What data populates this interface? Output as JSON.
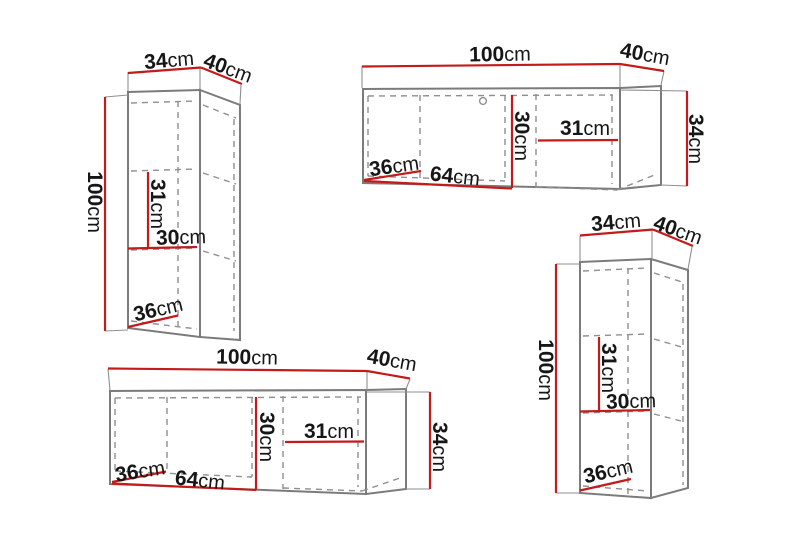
{
  "page": {
    "background": "#ffffff",
    "description_labels_only": true
  },
  "colors": {
    "measure_line": "#c41a1a",
    "cabinet_outline": "#7b7b7b",
    "interior_dashed": "#8f8f8f",
    "label_text": "#161616"
  },
  "cabinets": [
    {
      "name": "tall-wall-cabinet-top-left",
      "orientation": "vertical",
      "dimensions": {
        "width": {
          "value": "34",
          "unit": "cm"
        },
        "depth": {
          "value": "40",
          "unit": "cm"
        },
        "height": {
          "value": "100",
          "unit": "cm"
        },
        "compartment_height": {
          "value": "31",
          "unit": "cm"
        },
        "compartment_width": {
          "value": "30",
          "unit": "cm"
        },
        "base_depth": {
          "value": "36",
          "unit": "cm"
        }
      }
    },
    {
      "name": "wide-wall-cabinet-top-right",
      "orientation": "horizontal",
      "has_knob": true,
      "dimensions": {
        "width": {
          "value": "100",
          "unit": "cm"
        },
        "depth": {
          "value": "40",
          "unit": "cm"
        },
        "height": {
          "value": "34",
          "unit": "cm"
        },
        "compartment_height": {
          "value": "30",
          "unit": "cm"
        },
        "compartment_width": {
          "value": "31",
          "unit": "cm"
        },
        "base_depth": {
          "value": "36",
          "unit": "cm"
        },
        "door_width": {
          "value": "64",
          "unit": "cm"
        }
      }
    },
    {
      "name": "wide-wall-cabinet-bottom-left",
      "orientation": "horizontal",
      "has_knob": false,
      "dimensions": {
        "width": {
          "value": "100",
          "unit": "cm"
        },
        "depth": {
          "value": "40",
          "unit": "cm"
        },
        "height": {
          "value": "34",
          "unit": "cm"
        },
        "compartment_height": {
          "value": "30",
          "unit": "cm"
        },
        "compartment_width": {
          "value": "31",
          "unit": "cm"
        },
        "base_depth": {
          "value": "36",
          "unit": "cm"
        },
        "door_width": {
          "value": "64",
          "unit": "cm"
        }
      }
    },
    {
      "name": "tall-wall-cabinet-bottom-right",
      "orientation": "vertical",
      "dimensions": {
        "width": {
          "value": "34",
          "unit": "cm"
        },
        "depth": {
          "value": "40",
          "unit": "cm"
        },
        "height": {
          "value": "100",
          "unit": "cm"
        },
        "compartment_height": {
          "value": "31",
          "unit": "cm"
        },
        "compartment_width": {
          "value": "30",
          "unit": "cm"
        },
        "base_depth": {
          "value": "36",
          "unit": "cm"
        }
      }
    }
  ]
}
